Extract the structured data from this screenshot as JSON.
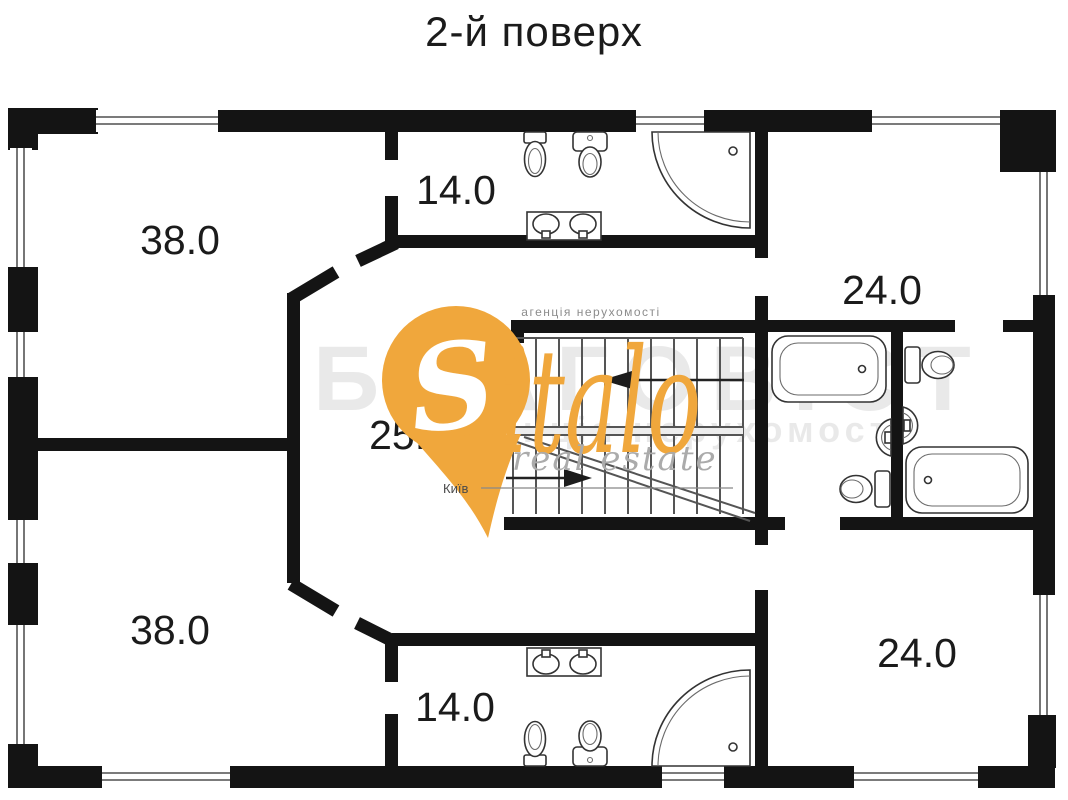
{
  "title": "2-й поверх",
  "rooms": [
    {
      "id": "room-top-left",
      "area": "38.0"
    },
    {
      "id": "bathroom-top",
      "area": "14.0"
    },
    {
      "id": "room-top-right",
      "area": "24.0"
    },
    {
      "id": "hall-center",
      "area": "25.0"
    },
    {
      "id": "room-bottom-left",
      "area": "38.0"
    },
    {
      "id": "bathroom-bottom",
      "area": "14.0"
    },
    {
      "id": "room-bottom-right",
      "area": "24.0"
    }
  ],
  "watermark": {
    "agency_label": "агенція нерухомості",
    "brand_initial": "S",
    "brand_rest": "italo",
    "tagline": "real estate",
    "city": "Київ",
    "accent_color": "#F0A73C",
    "ghost_title": "БЛАГОВІСТ",
    "ghost_subtitle": "агенція нерухомості"
  },
  "fixture_icons": [
    "toilet-icon",
    "bidet-icon",
    "double-sink-vanity-icon",
    "corner-shower-icon",
    "bathtub-icon",
    "washbasin-icon",
    "staircase-icon",
    "stair-direction-arrow-icon",
    "window-icon",
    "location-pin-icon"
  ]
}
